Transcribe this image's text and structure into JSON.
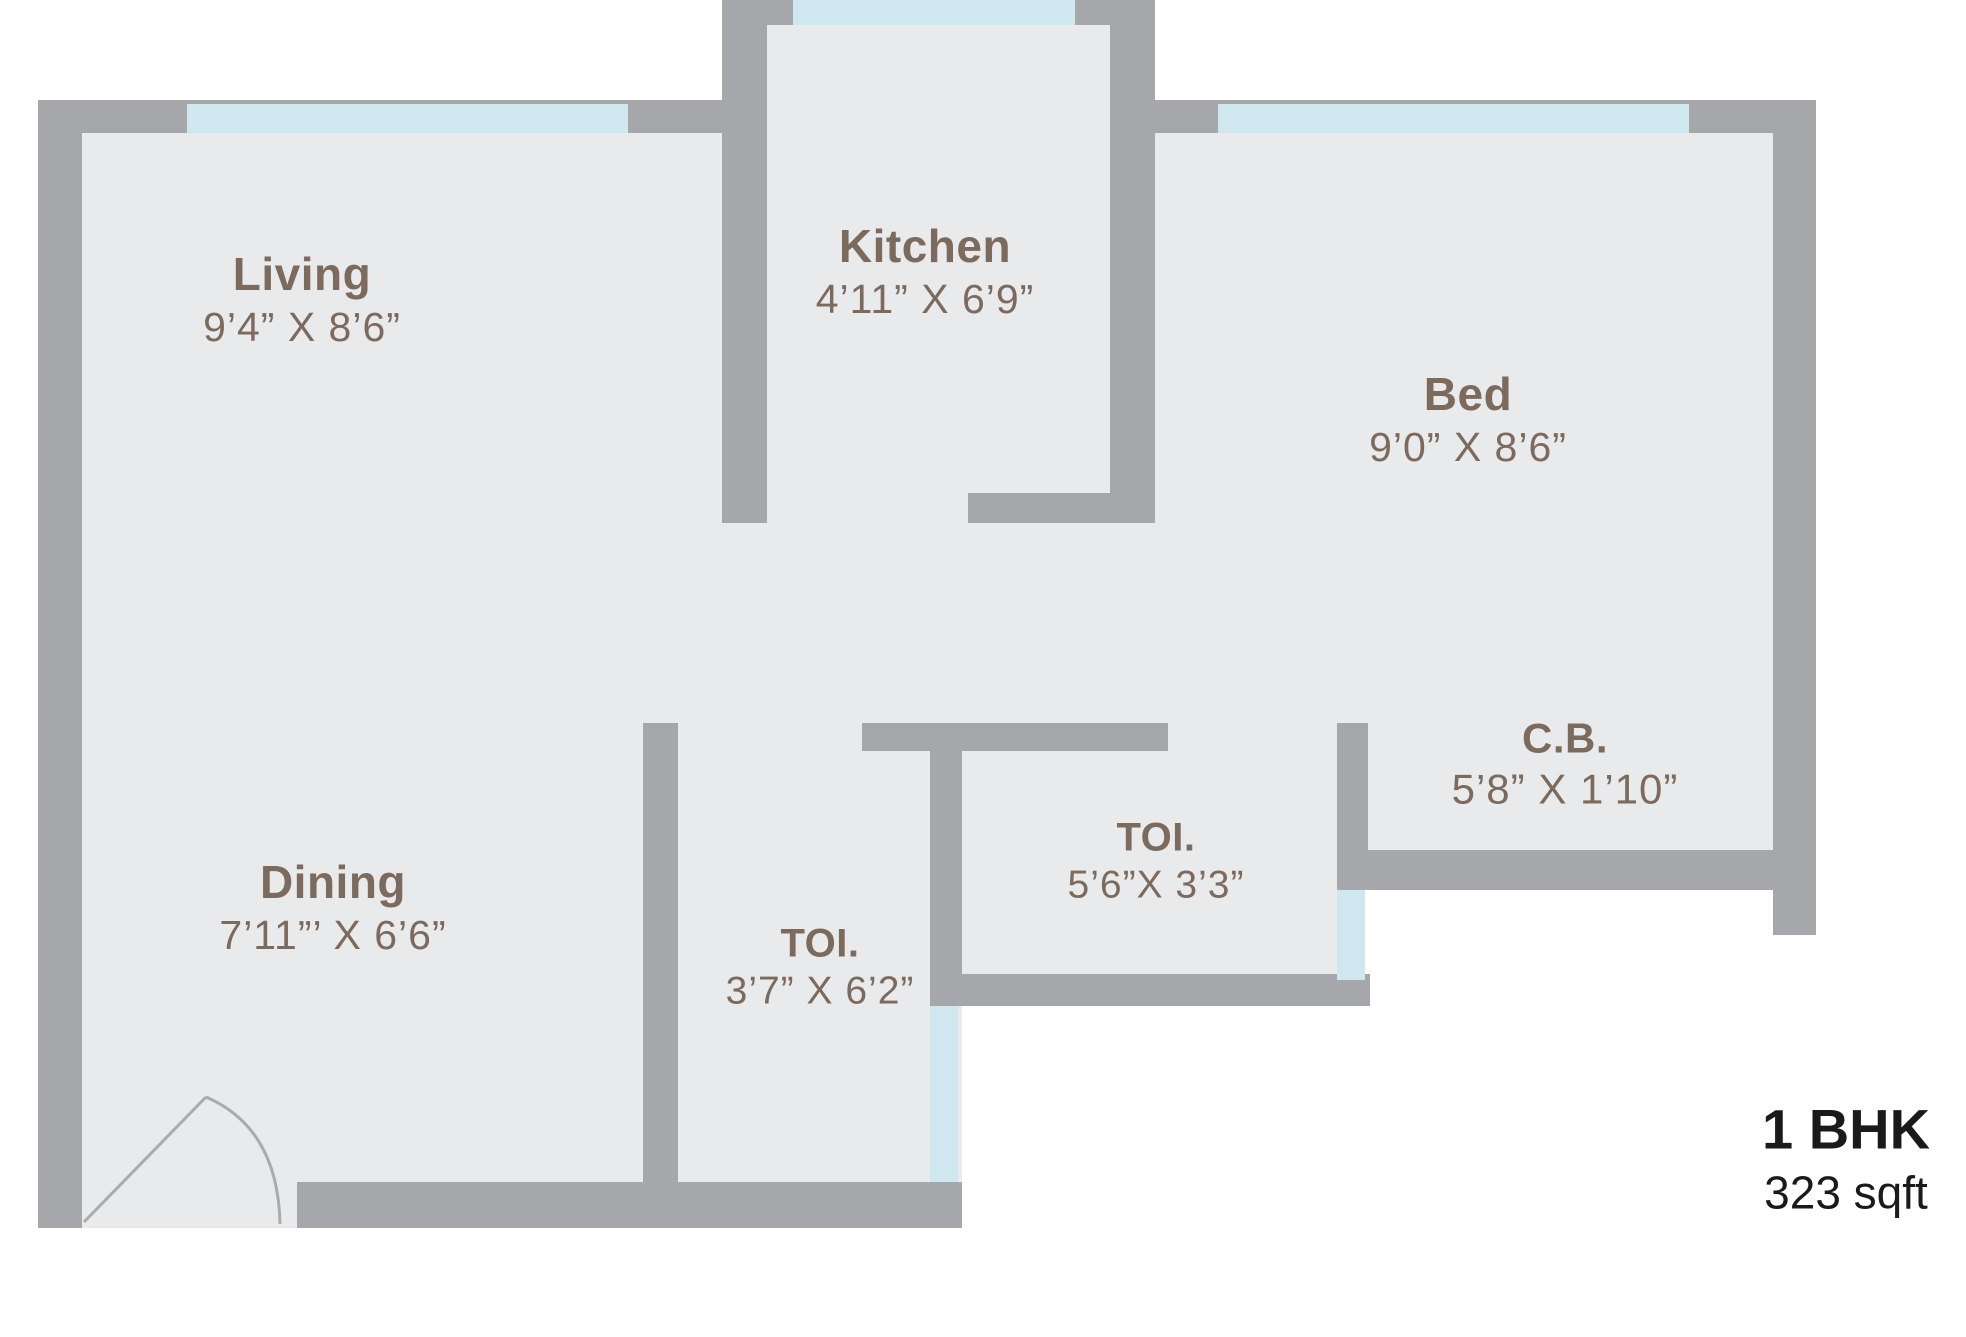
{
  "plan": {
    "unit_type": "1 BHK",
    "unit_area": "323 sqft"
  },
  "rooms": [
    {
      "id": "living",
      "name": "Living",
      "dimensions": "9’4” X 8’6”"
    },
    {
      "id": "kitchen",
      "name": "Kitchen",
      "dimensions": "4’11” X 6’9”"
    },
    {
      "id": "bed",
      "name": "Bed",
      "dimensions": "9’0” X 8’6”"
    },
    {
      "id": "dining",
      "name": "Dining",
      "dimensions": "7’11”’ X 6’6”"
    },
    {
      "id": "toilet-1",
      "name": "TOI.",
      "dimensions": "3’7” X 6’2”"
    },
    {
      "id": "toilet-2",
      "name": "TOI.",
      "dimensions": "5’6”X 3’3”"
    },
    {
      "id": "cupboard",
      "name": "C.B.",
      "dimensions": "5’8” X 1’10”"
    }
  ],
  "colors": {
    "wall": "#a5a7aa",
    "floor": "#e9eaec",
    "window": "#cfe7ee",
    "room_label": "#7c6a5d",
    "unit_label": "#1a1a1a",
    "background": "#ffffff"
  }
}
